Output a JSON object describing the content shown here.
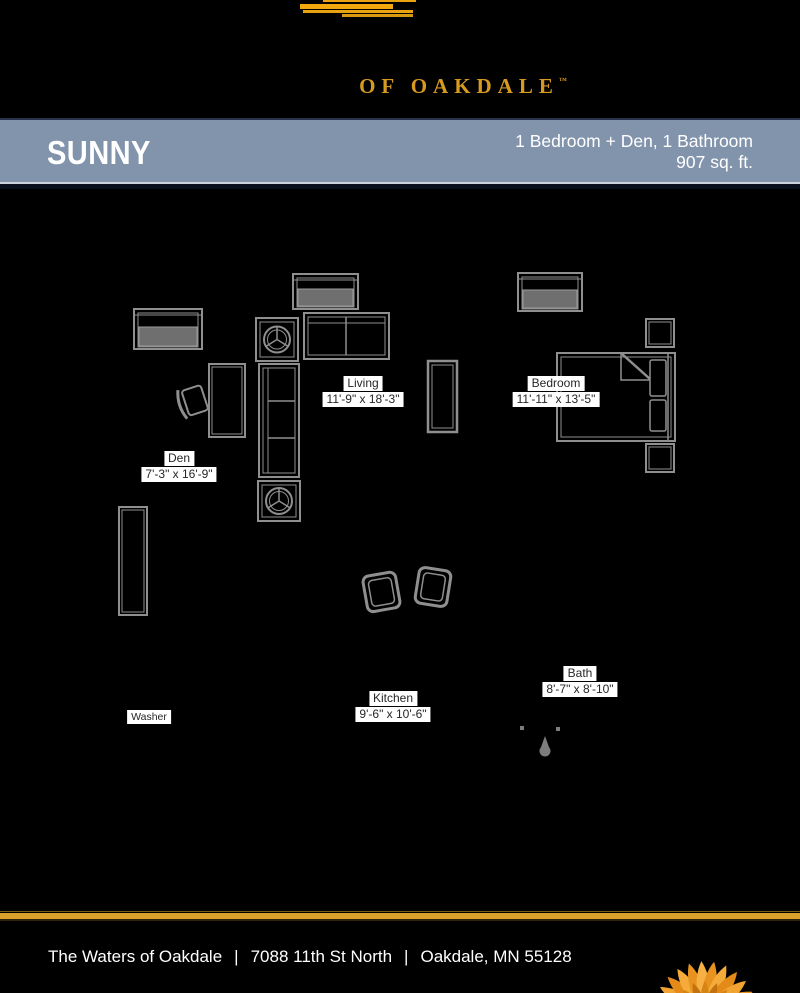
{
  "brand": {
    "logo_text": "OF OAKDALE",
    "trademark": "™",
    "gold_color": "#E2A31C"
  },
  "banner": {
    "plan_name": "SUNNY",
    "spec_line": "1 Bedroom + Den, 1 Bathroom",
    "area_line": "907 sq. ft.",
    "background_color": "#8294AC"
  },
  "floorplan": {
    "rooms": [
      {
        "name": "Living",
        "dims": "11'-9\" x 18'-3\""
      },
      {
        "name": "Bedroom",
        "dims": "11'-11\" x 13'-5\""
      },
      {
        "name": "Den",
        "dims": "7'-3\" x 16'-9\""
      },
      {
        "name": "Kitchen",
        "dims": "9'-6\" x 10'-6\""
      },
      {
        "name": "Bath",
        "dims": "8'-7\" x 8'-10\""
      }
    ],
    "washer_label": "Washer"
  },
  "footer": {
    "community": "The Waters of Oakdale",
    "street": "7088 11th St North",
    "city": "Oakdale, MN 55128",
    "separator": "|"
  }
}
